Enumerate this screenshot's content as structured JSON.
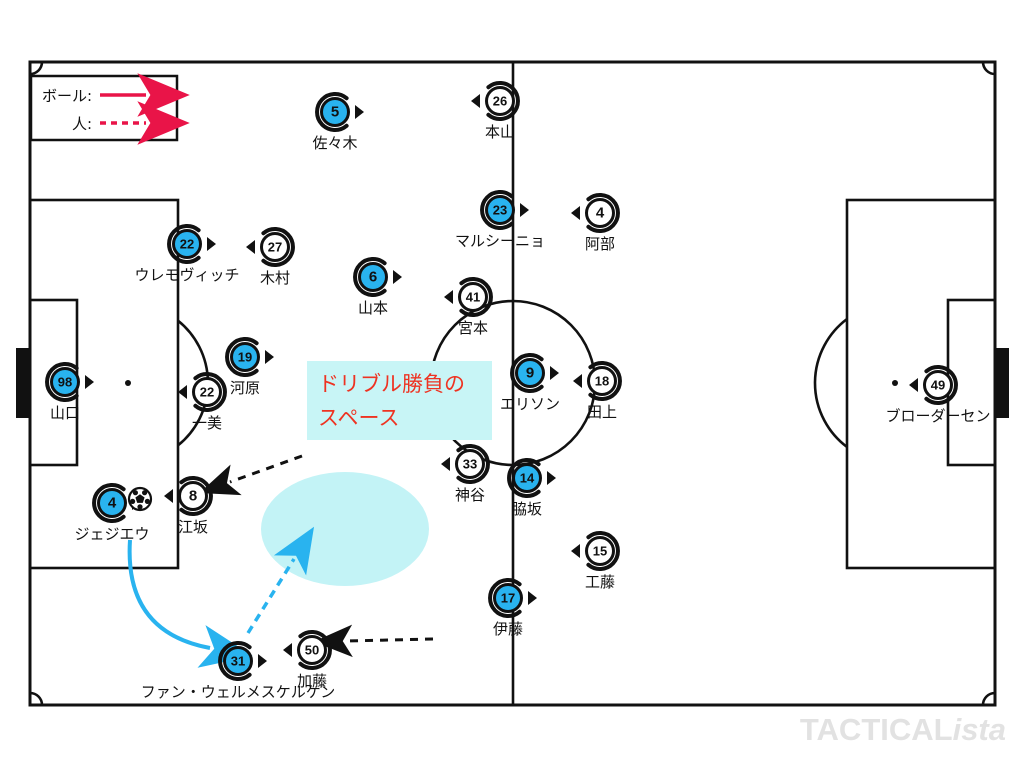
{
  "colors": {
    "team_a": "#29b3ef",
    "team_b": "#ffffff",
    "outline": "#111111",
    "legend_arrow": "#e91448",
    "cyan_arrow": "#29b3ef",
    "black_arrow": "#111111",
    "zone_fill": "#c3f3f6",
    "annotation_bg": "#c8f5f6",
    "annotation_text": "#ee3322",
    "watermark": "#e2e2e2"
  },
  "legend": {
    "ball_label": "ボール:",
    "person_label": "人:"
  },
  "annotation": {
    "line1": "ドリブル勝負の",
    "line2": "スペース"
  },
  "watermark": {
    "bold": "TACTICAL",
    "italic": "ista"
  },
  "zone": {
    "cx": 345,
    "cy": 529,
    "rx": 84,
    "ry": 57
  },
  "ball": {
    "x": 140,
    "y": 499
  },
  "players": [
    {
      "num": "5",
      "name": "佐々木",
      "x": 335,
      "y": 112,
      "team": "a",
      "facing": "right"
    },
    {
      "num": "26",
      "name": "本山",
      "x": 500,
      "y": 101,
      "team": "b",
      "facing": "left"
    },
    {
      "num": "23",
      "name": "マルシーニョ",
      "x": 500,
      "y": 210,
      "team": "a",
      "facing": "right"
    },
    {
      "num": "4",
      "name": "阿部",
      "x": 600,
      "y": 213,
      "team": "b",
      "facing": "left"
    },
    {
      "num": "22",
      "name": "ウレモヴィッチ",
      "x": 187,
      "y": 244,
      "team": "a",
      "facing": "right"
    },
    {
      "num": "27",
      "name": "木村",
      "x": 275,
      "y": 247,
      "team": "b",
      "facing": "left"
    },
    {
      "num": "6",
      "name": "山本",
      "x": 373,
      "y": 277,
      "team": "a",
      "facing": "right"
    },
    {
      "num": "41",
      "name": "宮本",
      "x": 473,
      "y": 297,
      "team": "b",
      "facing": "left"
    },
    {
      "num": "19",
      "name": "河原",
      "x": 245,
      "y": 357,
      "team": "a",
      "facing": "right"
    },
    {
      "num": "22",
      "name": "一美",
      "x": 207,
      "y": 392,
      "team": "b",
      "facing": "left"
    },
    {
      "num": "9",
      "name": "エリソン",
      "x": 530,
      "y": 373,
      "team": "a",
      "facing": "right"
    },
    {
      "num": "18",
      "name": "田上",
      "x": 602,
      "y": 381,
      "team": "b",
      "facing": "left"
    },
    {
      "num": "98",
      "name": "山口",
      "x": 65,
      "y": 382,
      "team": "a",
      "facing": "right"
    },
    {
      "num": "49",
      "name": "ブローダーセン",
      "x": 938,
      "y": 385,
      "team": "b",
      "facing": "left"
    },
    {
      "num": "33",
      "name": "神谷",
      "x": 470,
      "y": 464,
      "team": "b",
      "facing": "left"
    },
    {
      "num": "14",
      "name": "脇坂",
      "x": 527,
      "y": 478,
      "team": "a",
      "facing": "right"
    },
    {
      "num": "4",
      "name": "ジェジエウ",
      "x": 112,
      "y": 503,
      "team": "a",
      "facing": "right"
    },
    {
      "num": "8",
      "name": "江坂",
      "x": 193,
      "y": 496,
      "team": "b",
      "facing": "left"
    },
    {
      "num": "15",
      "name": "工藤",
      "x": 600,
      "y": 551,
      "team": "b",
      "facing": "left"
    },
    {
      "num": "17",
      "name": "伊藤",
      "x": 508,
      "y": 598,
      "team": "a",
      "facing": "right"
    },
    {
      "num": "31",
      "name": "ファン・ウェルメスケルケン",
      "x": 238,
      "y": 661,
      "team": "a",
      "facing": "right"
    },
    {
      "num": "50",
      "name": "加藤",
      "x": 312,
      "y": 650,
      "team": "b",
      "facing": "left"
    }
  ],
  "arrows": [
    {
      "kind": "black-dashed",
      "path": "M302 456 L230 482"
    },
    {
      "kind": "black-dashed",
      "path": "M433 639 L346 641"
    },
    {
      "kind": "cyan-solid",
      "path": "M130 540 Q124 632 210 648"
    },
    {
      "kind": "cyan-dashed",
      "path": "M248 633 L294 559"
    }
  ]
}
